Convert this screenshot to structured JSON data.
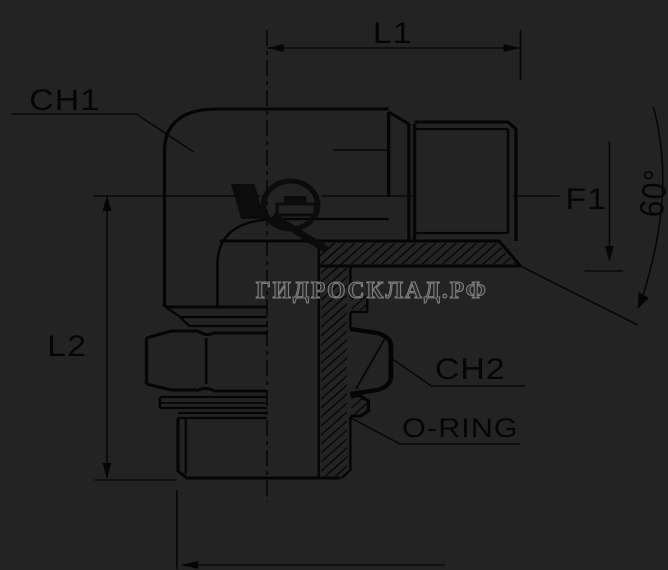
{
  "drawing": {
    "title": "90-degree elbow fitting half-section drawing",
    "labels": {
      "l1": "L1",
      "ch1": "CH1",
      "f1": "F1",
      "angle": "60°",
      "l2": "L2",
      "ch2": "CH2",
      "oring": "O-RING"
    },
    "watermark": {
      "text": "ГИДРОСКЛАД.РФ"
    },
    "colors": {
      "background": "#232323",
      "line": "#050505",
      "watermark": "#8f8f8f"
    }
  }
}
